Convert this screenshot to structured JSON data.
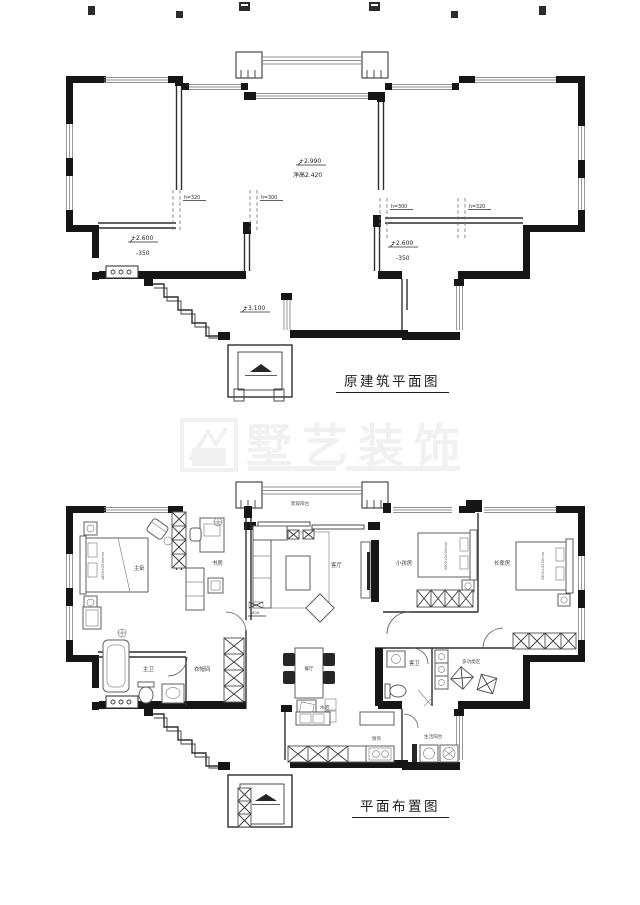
{
  "colors": {
    "wall": "#161616",
    "window_line": "#8f8f8f",
    "furniture_line": "#5f5f5f",
    "label_text": "#3c3c3c",
    "background": "#ffffff"
  },
  "watermark": {
    "text": "墅艺装饰"
  },
  "top_plan": {
    "title": "原建筑平面图",
    "annotations": {
      "hall_level": "+2.990",
      "hall_clear_height": "净高2.420",
      "left_level": "+2.600",
      "left_drop": "-350",
      "right_level": "+2.600",
      "right_drop": "-350",
      "entry_level": "+3.100",
      "beam_left_a": "h=320",
      "beam_left_b": "h=300",
      "beam_right_a": "h=300",
      "beam_right_b": "h=320"
    }
  },
  "layout_plan": {
    "title": "平面布置图",
    "rooms": {
      "view_balcony": "景观阳台",
      "master_bedroom": "主卧",
      "study": "书房",
      "living_room": "客厅",
      "kids_room": "小孩房",
      "elders_room": "长辈房",
      "master_bath": "主卫",
      "cloakroom": "衣帽间",
      "dining": "餐厅",
      "water_bar": "水吧",
      "guest_bath": "客卫",
      "multi_zone": "多功能区",
      "kitchen": "厨房",
      "service_balcony": "生活阳台"
    },
    "beds": {
      "master": "1800×2000mm",
      "kids": "1500×2000mm",
      "elders": "1500×2000mm"
    },
    "dims": {
      "tv_wall": "800"
    }
  }
}
